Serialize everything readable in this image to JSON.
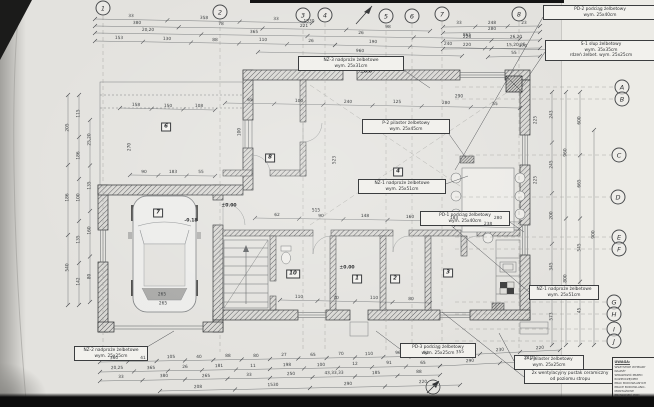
{
  "document": {
    "kind": "scanned architectural floor plan",
    "language": "pl"
  },
  "grid": {
    "top": [
      {
        "label": "1",
        "x": 103,
        "y": 8
      },
      {
        "label": "2",
        "x": 220,
        "y": 12
      },
      {
        "label": "3",
        "x": 303,
        "y": 15
      },
      {
        "label": "4",
        "x": 325,
        "y": 15
      },
      {
        "label": "5",
        "x": 386,
        "y": 16
      },
      {
        "label": "6",
        "x": 412,
        "y": 16
      },
      {
        "label": "7",
        "x": 442,
        "y": 14
      },
      {
        "label": "8",
        "x": 519,
        "y": 14
      }
    ],
    "right": [
      {
        "label": "A",
        "x": 622,
        "y": 87
      },
      {
        "label": "B",
        "x": 622,
        "y": 99
      },
      {
        "label": "C",
        "x": 619,
        "y": 155
      },
      {
        "label": "D",
        "x": 618,
        "y": 197
      },
      {
        "label": "E",
        "x": 619,
        "y": 237
      },
      {
        "label": "F",
        "x": 619,
        "y": 249
      },
      {
        "label": "G",
        "x": 614,
        "y": 302
      },
      {
        "label": "H",
        "x": 614,
        "y": 314
      },
      {
        "label": "I",
        "x": 614,
        "y": 329
      },
      {
        "label": "J",
        "x": 614,
        "y": 341
      }
    ]
  },
  "rooms": [
    {
      "num": "1",
      "x": 357,
      "y": 279
    },
    {
      "num": "2",
      "x": 395,
      "y": 279
    },
    {
      "num": "3",
      "x": 448,
      "y": 273
    },
    {
      "num": "4",
      "x": 398,
      "y": 172
    },
    {
      "num": "6",
      "x": 166,
      "y": 127
    },
    {
      "num": "7",
      "x": 158,
      "y": 213
    },
    {
      "num": "8",
      "x": 270,
      "y": 158
    },
    {
      "num": "10",
      "x": 293,
      "y": 274
    }
  ],
  "levels": [
    {
      "x": 229,
      "y": 206,
      "v": "±0.00"
    },
    {
      "x": 347,
      "y": 268,
      "v": "±0.00"
    },
    {
      "x": 191,
      "y": 221,
      "v": "-0.18"
    },
    {
      "x": 366,
      "y": 72,
      "v": "±0.0"
    }
  ],
  "annotations": [
    {
      "id": "pd2",
      "x": 543,
      "y": 5,
      "w": 108,
      "lines": [
        "PD-2 podciąg żelbetowy",
        "wym. 25x40cm"
      ],
      "leader": [
        543,
        17,
        455,
        170
      ]
    },
    {
      "id": "s1",
      "x": 545,
      "y": 40,
      "w": 106,
      "lines": [
        "S-1 słup żelbetowy",
        "wym. 35x35cm",
        "rdzeń żelbet. wym. 25x25cm"
      ],
      "leader": [
        545,
        52,
        522,
        86
      ]
    },
    {
      "id": "nz3",
      "x": 298,
      "y": 56,
      "w": 100,
      "lines": [
        "NZ-3 nadproże żelbetowe",
        "wym. 25x31cm"
      ],
      "leader": [
        398,
        66,
        430,
        88
      ]
    },
    {
      "id": "p2",
      "x": 362,
      "y": 119,
      "w": 82,
      "lines": [
        "P-2 pilaster żelbetowy",
        "wym. 25x45cm"
      ],
      "leader": [
        444,
        127,
        466,
        158
      ]
    },
    {
      "id": "nz1",
      "x": 358,
      "y": 179,
      "w": 82,
      "lines": [
        "NZ-1 nadproże żelbetowe",
        "wym. 25x51cm"
      ],
      "leader": [
        440,
        186,
        468,
        176
      ]
    },
    {
      "id": "pd1",
      "x": 420,
      "y": 211,
      "w": 84,
      "lines": [
        "PD-1 podciąg żelbetowy",
        "wym. 25x40cm"
      ],
      "leader": [
        504,
        218,
        524,
        232
      ]
    },
    {
      "id": "nz2",
      "x": 74,
      "y": 346,
      "w": 68,
      "lines": [
        "NZ-2 nadproże żelbetowe",
        "wym. 25x25cm"
      ],
      "leader": [
        142,
        350,
        174,
        331
      ]
    },
    {
      "id": "pd3",
      "x": 400,
      "y": 343,
      "w": 70,
      "lines": [
        "PD-3 podciąg żelbetowy",
        "wym. 25x25cm"
      ],
      "leader": [
        400,
        349,
        376,
        331
      ]
    },
    {
      "id": "nz1b",
      "x": 529,
      "y": 285,
      "w": 64,
      "lines": [
        "NZ-1 nadproże żelbetowe",
        "wym. 25x51cm"
      ],
      "leader": [
        529,
        292,
        447,
        222
      ]
    },
    {
      "id": "p1",
      "x": 514,
      "y": 355,
      "w": 64,
      "lines": [
        "P-1 pilaster żelbetowy",
        "wym. 25x25cm"
      ],
      "leader": [
        514,
        361,
        499,
        333
      ]
    },
    {
      "id": "vent",
      "x": 524,
      "y": 369,
      "w": 86,
      "lines": [
        "2x wentylacyjny pustak ceramiczny",
        "od poziomu stropu"
      ],
      "leader": [
        524,
        377,
        442,
        312
      ]
    }
  ],
  "note_box": {
    "title": "UWAGA:",
    "lines": [
      "WSZYSTKIE WYMIARY NALEŻY",
      "SPRAWDZIĆ PRZED ROZPOCZĘCIEM",
      "PRAC BUDOWLANYCH",
      "PRACE BUDOWLANO-MONTAŻOWE",
      "PROWADZIĆ POD NADZOREM"
    ]
  },
  "dim_chains": [
    {
      "x1": 95,
      "y1": 19,
      "x2": 312,
      "y2": 23,
      "vals": [
        "33",
        "358",
        "33"
      ]
    },
    {
      "x1": 95,
      "y1": 26,
      "x2": 430,
      "y2": 31,
      "vals": [
        "380",
        "78",
        "221",
        "98"
      ]
    },
    {
      "x1": 95,
      "y1": 33,
      "x2": 520,
      "y2": 39,
      "vals": [
        "20,20",
        "365",
        "26",
        "865"
      ]
    },
    {
      "x1": 95,
      "y1": 41,
      "x2": 335,
      "y2": 45,
      "vals": [
        "153",
        "130",
        "88",
        "110",
        "26"
      ]
    },
    {
      "x1": 335,
      "y1": 45,
      "x2": 560,
      "y2": 50,
      "vals": [
        "190",
        "240",
        "170"
      ]
    },
    {
      "x1": 258,
      "y1": 52,
      "x2": 462,
      "y2": 56,
      "vals": [
        "960"
      ]
    },
    {
      "x1": 443,
      "y1": 27,
      "x2": 540,
      "y2": 26,
      "vals": [
        "33",
        "248",
        "23"
      ]
    },
    {
      "x1": 443,
      "y1": 33,
      "x2": 540,
      "y2": 32,
      "vals": [
        "280"
      ]
    },
    {
      "x1": 443,
      "y1": 41,
      "x2": 540,
      "y2": 40,
      "vals": [
        "226",
        "26,20"
      ]
    },
    {
      "x1": 443,
      "y1": 49,
      "x2": 540,
      "y2": 48,
      "vals": [
        "220",
        "15,20,25"
      ]
    },
    {
      "x1": 488,
      "y1": 57,
      "x2": 540,
      "y2": 56,
      "vals": [
        "55"
      ]
    },
    {
      "x1": 552,
      "y1": 92,
      "x2": 552,
      "y2": 345,
      "vals": [
        "243",
        "245",
        "200",
        "345",
        "573"
      ]
    },
    {
      "x1": 566,
      "y1": 92,
      "x2": 566,
      "y2": 345,
      "vals": [
        "960",
        "800"
      ]
    },
    {
      "x1": 580,
      "y1": 92,
      "x2": 580,
      "y2": 345,
      "vals": [
        "600",
        "665",
        "545",
        "45"
      ]
    },
    {
      "x1": 594,
      "y1": 130,
      "x2": 594,
      "y2": 345,
      "vals": [
        "900"
      ]
    },
    {
      "x1": 68,
      "y1": 95,
      "x2": 68,
      "y2": 305,
      "vals": [
        "205",
        "186",
        "540"
      ]
    },
    {
      "x1": 79,
      "y1": 95,
      "x2": 79,
      "y2": 305,
      "vals": [
        "115",
        "186",
        "100",
        "135",
        "142"
      ]
    },
    {
      "x1": 90,
      "y1": 120,
      "x2": 90,
      "y2": 302,
      "vals": [
        "25,20",
        "135",
        "160",
        "80"
      ]
    },
    {
      "x1": 100,
      "y1": 362,
      "x2": 440,
      "y2": 356,
      "vals": [
        "360",
        "41",
        "105",
        "40",
        "88",
        "80",
        "27",
        "65",
        "70",
        "110",
        "96",
        "51"
      ]
    },
    {
      "x1": 100,
      "y1": 372,
      "x2": 440,
      "y2": 366,
      "vals": [
        "20,25",
        "365",
        "26",
        "181",
        "11",
        "198",
        "100",
        "12",
        "91",
        "65"
      ]
    },
    {
      "x1": 100,
      "y1": 381,
      "x2": 440,
      "y2": 375,
      "vals": [
        "33",
        "380",
        "265",
        "33",
        "250",
        "43,33,33",
        "185",
        "88"
      ]
    },
    {
      "x1": 160,
      "y1": 391,
      "x2": 460,
      "y2": 385,
      "vals": [
        "208",
        "1530",
        "290",
        "220"
      ]
    },
    {
      "x1": 440,
      "y1": 356,
      "x2": 560,
      "y2": 350,
      "vals": [
        "355",
        "230",
        "220"
      ]
    },
    {
      "x1": 440,
      "y1": 366,
      "x2": 560,
      "y2": 360,
      "vals": [
        "290",
        "23,25"
      ]
    },
    {
      "x1": 120,
      "y1": 108,
      "x2": 215,
      "y2": 110,
      "vals": [
        "158",
        "150",
        "108"
      ]
    },
    {
      "x1": 225,
      "y1": 103,
      "x2": 520,
      "y2": 108,
      "vals": [
        "65",
        "100",
        "240",
        "125",
        "280",
        "55"
      ]
    },
    {
      "x1": 255,
      "y1": 218,
      "x2": 520,
      "y2": 222,
      "vals": [
        "62",
        "90",
        "148",
        "160",
        "183",
        "280"
      ]
    },
    {
      "x1": 130,
      "y1": 175,
      "x2": 215,
      "y2": 176,
      "vals": [
        "90",
        "183",
        "55"
      ]
    },
    {
      "x1": 280,
      "y1": 300,
      "x2": 430,
      "y2": 303,
      "vals": [
        "110",
        "70",
        "110",
        "80"
      ]
    },
    {
      "x1": 455,
      "y1": 226,
      "x2": 520,
      "y2": 228,
      "vals": [
        "238"
      ]
    }
  ],
  "dim_floats": [
    {
      "x": 309,
      "y": 22,
      "v": "1530"
    },
    {
      "x": 316,
      "y": 211,
      "v": "515"
    },
    {
      "x": 162,
      "y": 295,
      "v": "265"
    },
    {
      "x": 163,
      "y": 304,
      "v": "265"
    },
    {
      "x": 130,
      "y": 147,
      "v": "270",
      "r": true
    },
    {
      "x": 240,
      "y": 132,
      "v": "100",
      "r": true
    },
    {
      "x": 459,
      "y": 97,
      "v": "290"
    },
    {
      "x": 536,
      "y": 120,
      "v": "225",
      "r": true
    },
    {
      "x": 536,
      "y": 180,
      "v": "225",
      "r": true
    },
    {
      "x": 335,
      "y": 160,
      "v": "523",
      "r": true
    }
  ],
  "symbols": {
    "north_arrow_top": "north-arrow",
    "north_arrow_bottom": "north-arrow-circle",
    "car": "car-top-view",
    "dining_table": "dining-table-with-chairs",
    "stairs": "staircase",
    "column_s1": "reinforced-column-S1"
  },
  "colors": {
    "paper": "#e3e2de",
    "ink": "#2f3133",
    "wall_hatch": "#55565a",
    "scan_band": "#0c0c0c",
    "dash_grid": "#9a9a96"
  }
}
